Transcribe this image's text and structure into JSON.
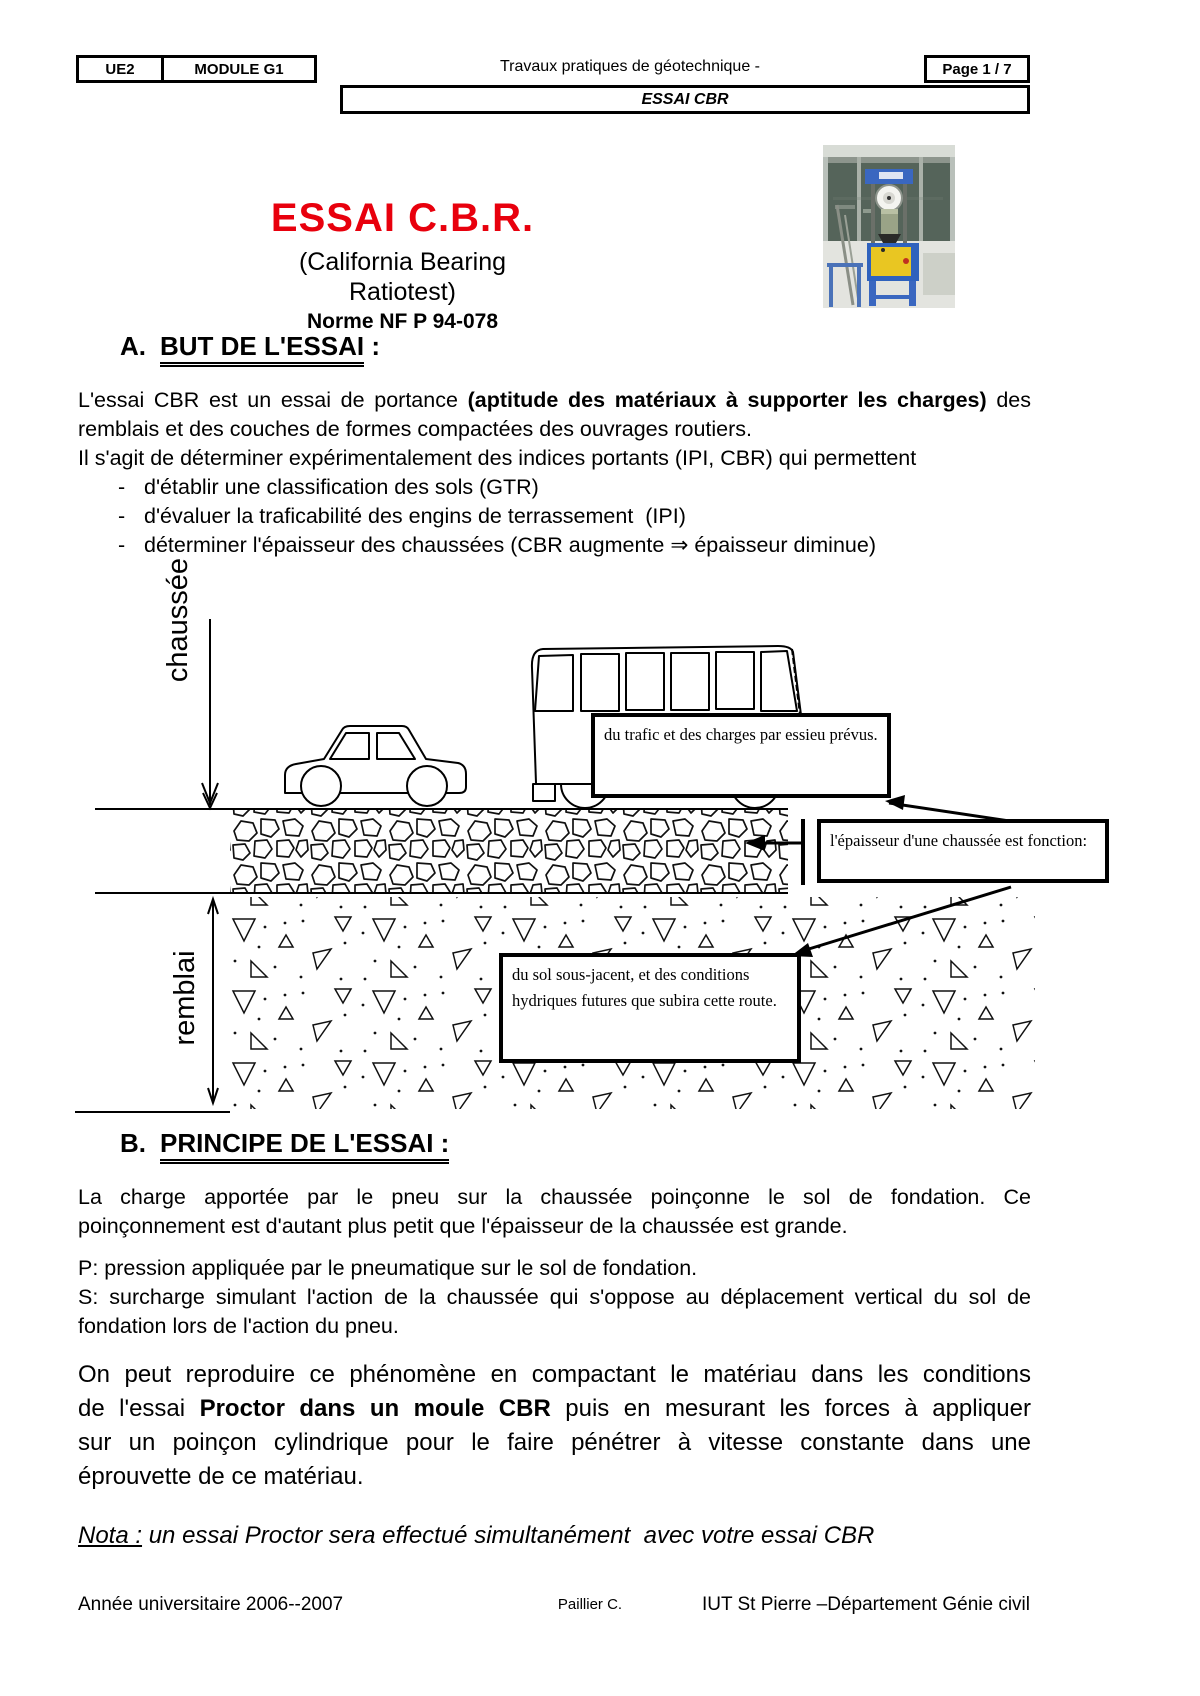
{
  "header": {
    "ue": "UE2",
    "module": "MODULE G1",
    "course": "Travaux pratiques de géotechnique -",
    "page": "Page 1 / 7",
    "banner": "ESSAI CBR"
  },
  "title": {
    "main": "ESSAI C.B.R.",
    "subtitle": "(California Bearing Ratiotest)",
    "norm": "Norme NF P 94-078",
    "accent_color": "#e8000d"
  },
  "photo": {
    "alt": "presse d'essai CBR"
  },
  "section_a": {
    "letter": "A.",
    "heading": "BUT DE L'ESSAI",
    "colon": " :",
    "l1_pre": "L'essai CBR est un essai de portance ",
    "l1_bold": "(aptitude des matériaux à supporter les charges)",
    "l1_post": " des",
    "l2": "remblais et des couches de formes compactées des ouvrages routiers.",
    "l3": "Il s'agit de déterminer expérimentalement des indices portants (IPI, CBR) qui permettent",
    "bullets": [
      "d'établir une classification des sols (GTR)",
      "d'évaluer la traficabilité des engins de terrassement  (IPI)",
      "déterminer l'épaisseur des chaussées (CBR augmente ⇒ épaisseur diminue)"
    ]
  },
  "diagram": {
    "label_chaussee": "chaussée",
    "label_remblai": "remblai",
    "box_traffic": "du trafic et des charges par essieu prévus.",
    "box_thickness": "l'épaisseur d'une chaussée est fonction:",
    "box_soil": "du sol sous-jacent, et des conditions hydriques futures que subira cette route."
  },
  "section_b": {
    "letter": "B.",
    "heading": "PRINCIPE DE L'ESSAI :",
    "p1_l1": "La charge apportée par le pneu sur la chaussée poinçonne le sol de fondation. Ce",
    "p1_l2": "poinçonnement est d'autant plus petit que l'épaisseur de la chaussée est grande.",
    "p_def": "P: pression appliquée par le pneumatique sur le sol de fondation.",
    "s_l1": "S: surcharge simulant l'action de la chaussée qui s'oppose au déplacement vertical du sol de",
    "s_l2": "fondation lors de l'action du pneu.",
    "big_l1": "On peut reproduire ce phénomène en compactant le matériau dans les conditions",
    "big_l2_pre": "de l'essai ",
    "big_l2_bold": "Proctor dans un moule CBR",
    "big_l2_post": " puis en mesurant les forces à appliquer",
    "big_l3": "sur un poinçon cylindrique pour le faire pénétrer à vitesse constante dans une",
    "big_l4": "éprouvette de ce matériau.",
    "nota_label": "Nota :",
    "nota_text": " un essai Proctor sera effectué simultanément  avec votre essai CBR"
  },
  "footer": {
    "left": "Année universitaire 2006--2007",
    "center": "Paillier C.",
    "right": "IUT St Pierre –Département Génie civil"
  }
}
